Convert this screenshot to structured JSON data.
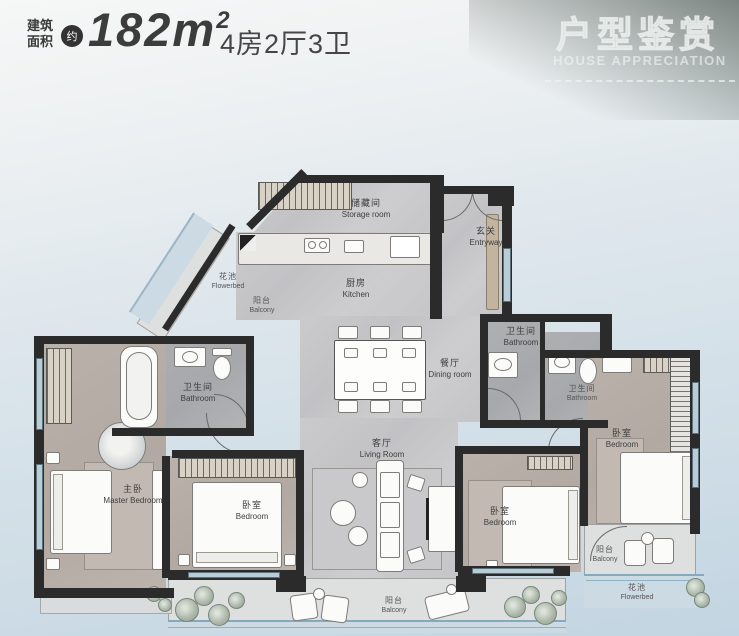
{
  "header": {
    "area_label_line1": "建筑",
    "area_label_line2": "面积",
    "approx_badge": "约",
    "area_value": "182m",
    "area_superscript": "2",
    "layout_text": "4房2厅3卫",
    "banner_title": "户型鉴赏",
    "banner_subtitle": "HOUSE APPRECIATION"
  },
  "rooms": {
    "storage": {
      "cn": "储藏间",
      "en": "Storage room"
    },
    "entryway": {
      "cn": "玄关",
      "en": "Entryway"
    },
    "kitchen": {
      "cn": "厨房",
      "en": "Kitchen"
    },
    "flowerbed_left": {
      "cn": "花池",
      "en": "Flowerbed"
    },
    "balcony_left": {
      "cn": "阳台",
      "en": "Balcony"
    },
    "bathroom_left": {
      "cn": "卫生间",
      "en": "Bathroom"
    },
    "bathroom_mid": {
      "cn": "卫生间",
      "en": "Bathroom"
    },
    "bathroom_right": {
      "cn": "卫生间",
      "en": "Bathroom"
    },
    "dining": {
      "cn": "餐厅",
      "en": "Dining room"
    },
    "living": {
      "cn": "客厅",
      "en": "Living Room"
    },
    "master_bedroom": {
      "cn": "主卧",
      "en": "Master Bedroom"
    },
    "bedroom_2": {
      "cn": "卧室",
      "en": "Bedroom"
    },
    "bedroom_3": {
      "cn": "卧室",
      "en": "Bedroom"
    },
    "bedroom_4": {
      "cn": "卧室",
      "en": "Bedroom"
    },
    "balcony_bottom": {
      "cn": "阳台",
      "en": "Balcony"
    },
    "balcony_right": {
      "cn": "阳台",
      "en": "Balcony"
    },
    "flowerbed_right": {
      "cn": "花池",
      "en": "Flowerbed"
    }
  },
  "colors": {
    "wall": "#2b2b2b",
    "floor_marble": "#c7c7c9",
    "floor_bedroom": "#b5ada5",
    "floor_bathroom": "#abadaf",
    "floor_balcony": "#dedfdf",
    "window_glass": "#b7ced9",
    "flowerbed_band": "#ccdae4",
    "background_bottom": "#c3d5e2",
    "header_text": "#3c3c3c",
    "banner_text": "#ebf0ee"
  }
}
